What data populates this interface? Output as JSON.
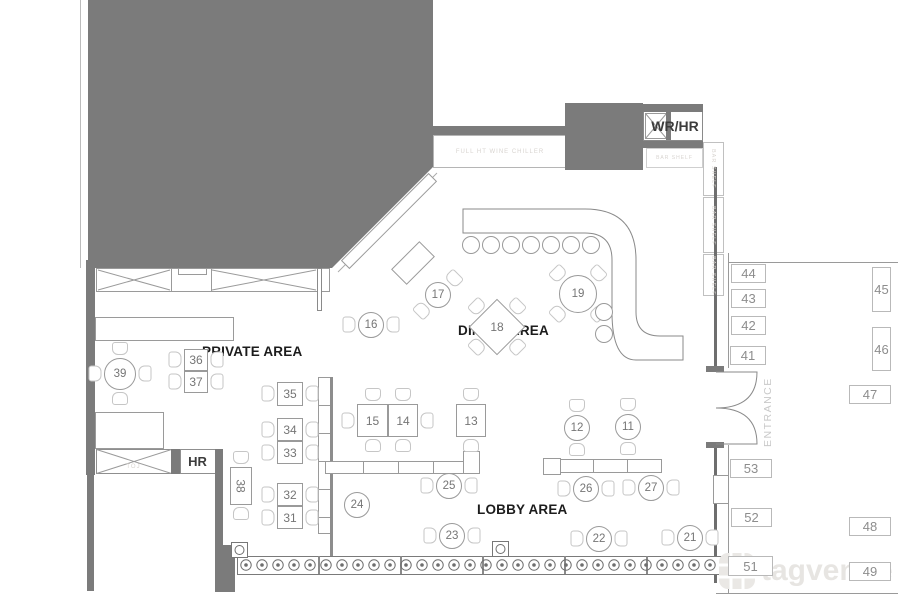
{
  "labels": {
    "private_area": "PRIVATE AREA",
    "dining_area": "DINING AREA",
    "lobby_area": "LOBBY AREA",
    "wr_hr": "WR/HR",
    "hr": "HR",
    "entrance": "ENTRANCE",
    "wine_chiller": "FULL HT WINE CHILLER",
    "bar_shelf": "BAR SHELF",
    "storage": "TOJ",
    "watermark": "tagvenue"
  },
  "colors": {
    "wall_dark": "#7b7b7b",
    "wall_line": "#6e6e6e",
    "furniture_line": "#9a9a9a",
    "chair_line": "#c6c6c6",
    "number_text": "#757575",
    "plaque_text": "#8d8d8d",
    "area_label_text": "#1c1c1c",
    "faint_text": "#d8d4d0",
    "watermark_gray": "#e7e5e2"
  },
  "furniture": {
    "round_tables": [
      {
        "n": "16",
        "cx": 371,
        "cy": 325,
        "r": 13,
        "chairs": [
          "w",
          "e"
        ]
      },
      {
        "n": "17",
        "cx": 438,
        "cy": 295,
        "r": 13,
        "chairs": [
          "ne",
          "sw"
        ]
      },
      {
        "n": "19",
        "cx": 578,
        "cy": 294,
        "r": 19,
        "chairs": [
          "nw",
          "ne",
          "sw",
          "se"
        ]
      },
      {
        "n": "39",
        "cx": 120,
        "cy": 374,
        "r": 16,
        "chairs": [
          "n",
          "s",
          "w",
          "e"
        ]
      },
      {
        "n": "12",
        "cx": 577,
        "cy": 428,
        "r": 13,
        "chairs": [
          "n",
          "s"
        ]
      },
      {
        "n": "11",
        "cx": 628,
        "cy": 427,
        "r": 13,
        "chairs": [
          "n",
          "s"
        ]
      },
      {
        "n": "25",
        "cx": 449,
        "cy": 486,
        "r": 13,
        "chairs": [
          "w",
          "e"
        ]
      },
      {
        "n": "26",
        "cx": 586,
        "cy": 489,
        "r": 13,
        "chairs": [
          "w",
          "e"
        ]
      },
      {
        "n": "27",
        "cx": 651,
        "cy": 488,
        "r": 13,
        "chairs": [
          "w",
          "e"
        ]
      },
      {
        "n": "23",
        "cx": 452,
        "cy": 536,
        "r": 13,
        "chairs": [
          "w",
          "e"
        ]
      },
      {
        "n": "22",
        "cx": 599,
        "cy": 539,
        "r": 13,
        "chairs": [
          "w",
          "e"
        ]
      },
      {
        "n": "21",
        "cx": 690,
        "cy": 538,
        "r": 13,
        "chairs": [
          "w",
          "e"
        ]
      },
      {
        "n": "24",
        "cx": 357,
        "cy": 505,
        "r": 13,
        "chairs": []
      }
    ],
    "diamond_tables": [
      {
        "n": "18",
        "cx": 497,
        "cy": 327,
        "size": 40,
        "chairs": [
          "nw",
          "ne",
          "sw",
          "se"
        ]
      }
    ],
    "square_tables": [
      {
        "n": "36",
        "x": 184,
        "y": 349,
        "w": 24,
        "h": 22,
        "chairs": [
          "w",
          "e"
        ]
      },
      {
        "n": "37",
        "x": 184,
        "y": 371,
        "w": 24,
        "h": 22,
        "chairs": [
          "w",
          "e"
        ]
      },
      {
        "n": "35",
        "x": 277,
        "y": 382,
        "w": 26,
        "h": 24,
        "chairs": [
          "w",
          "e"
        ]
      },
      {
        "n": "34",
        "x": 277,
        "y": 418,
        "w": 26,
        "h": 23,
        "chairs": [
          "w",
          "e"
        ]
      },
      {
        "n": "33",
        "x": 277,
        "y": 441,
        "w": 26,
        "h": 23,
        "chairs": [
          "w",
          "e"
        ]
      },
      {
        "n": "32",
        "x": 277,
        "y": 483,
        "w": 26,
        "h": 23,
        "chairs": [
          "w",
          "e"
        ]
      },
      {
        "n": "31",
        "x": 277,
        "y": 506,
        "w": 26,
        "h": 23,
        "chairs": [
          "w",
          "e"
        ]
      },
      {
        "n": "38",
        "x": 230,
        "y": 467,
        "w": 22,
        "h": 38,
        "chairs": [
          "n",
          "s"
        ],
        "rot": 90
      },
      {
        "n": "15",
        "x": 357,
        "y": 404,
        "w": 31,
        "h": 33,
        "chairs": [
          "n",
          "s",
          "w"
        ]
      },
      {
        "n": "14",
        "x": 388,
        "y": 404,
        "w": 30,
        "h": 33,
        "chairs": [
          "n",
          "s",
          "e"
        ]
      },
      {
        "n": "13",
        "x": 456,
        "y": 404,
        "w": 30,
        "h": 33,
        "chairs": [
          "n",
          "s"
        ]
      }
    ],
    "wall_plaques": [
      {
        "n": "44",
        "x": 731,
        "y": 264,
        "w": 35,
        "h": 19
      },
      {
        "n": "43",
        "x": 731,
        "y": 289,
        "w": 35,
        "h": 19
      },
      {
        "n": "42",
        "x": 731,
        "y": 316,
        "w": 35,
        "h": 19
      },
      {
        "n": "41",
        "x": 730,
        "y": 346,
        "w": 36,
        "h": 19
      },
      {
        "n": "45",
        "x": 872,
        "y": 267,
        "w": 19,
        "h": 45
      },
      {
        "n": "46",
        "x": 872,
        "y": 327,
        "w": 19,
        "h": 44
      },
      {
        "n": "47",
        "x": 849,
        "y": 385,
        "w": 42,
        "h": 19
      },
      {
        "n": "53",
        "x": 730,
        "y": 459,
        "w": 42,
        "h": 19
      },
      {
        "n": "52",
        "x": 731,
        "y": 508,
        "w": 41,
        "h": 19
      },
      {
        "n": "48",
        "x": 849,
        "y": 517,
        "w": 42,
        "h": 19
      },
      {
        "n": "51",
        "x": 728,
        "y": 556,
        "w": 45,
        "h": 20
      },
      {
        "n": "49",
        "x": 849,
        "y": 562,
        "w": 42,
        "h": 19
      }
    ],
    "rotated_rects": [
      {
        "name": "diagonal-bench",
        "cx": 389,
        "cy": 221,
        "w": 124,
        "h": 12,
        "rot": -45
      },
      {
        "name": "diagonal-table",
        "cx": 413,
        "cy": 263,
        "w": 40,
        "h": 22,
        "rot": -45
      }
    ],
    "bar_stools": {
      "row_y": 245,
      "row_start_x": 471,
      "row_step": 20,
      "row_count": 7,
      "side": [
        [
          604,
          312
        ],
        [
          604,
          334
        ]
      ]
    },
    "balusters": {
      "y": 565,
      "start_x": 246,
      "end_x": 722,
      "step": 16
    }
  }
}
